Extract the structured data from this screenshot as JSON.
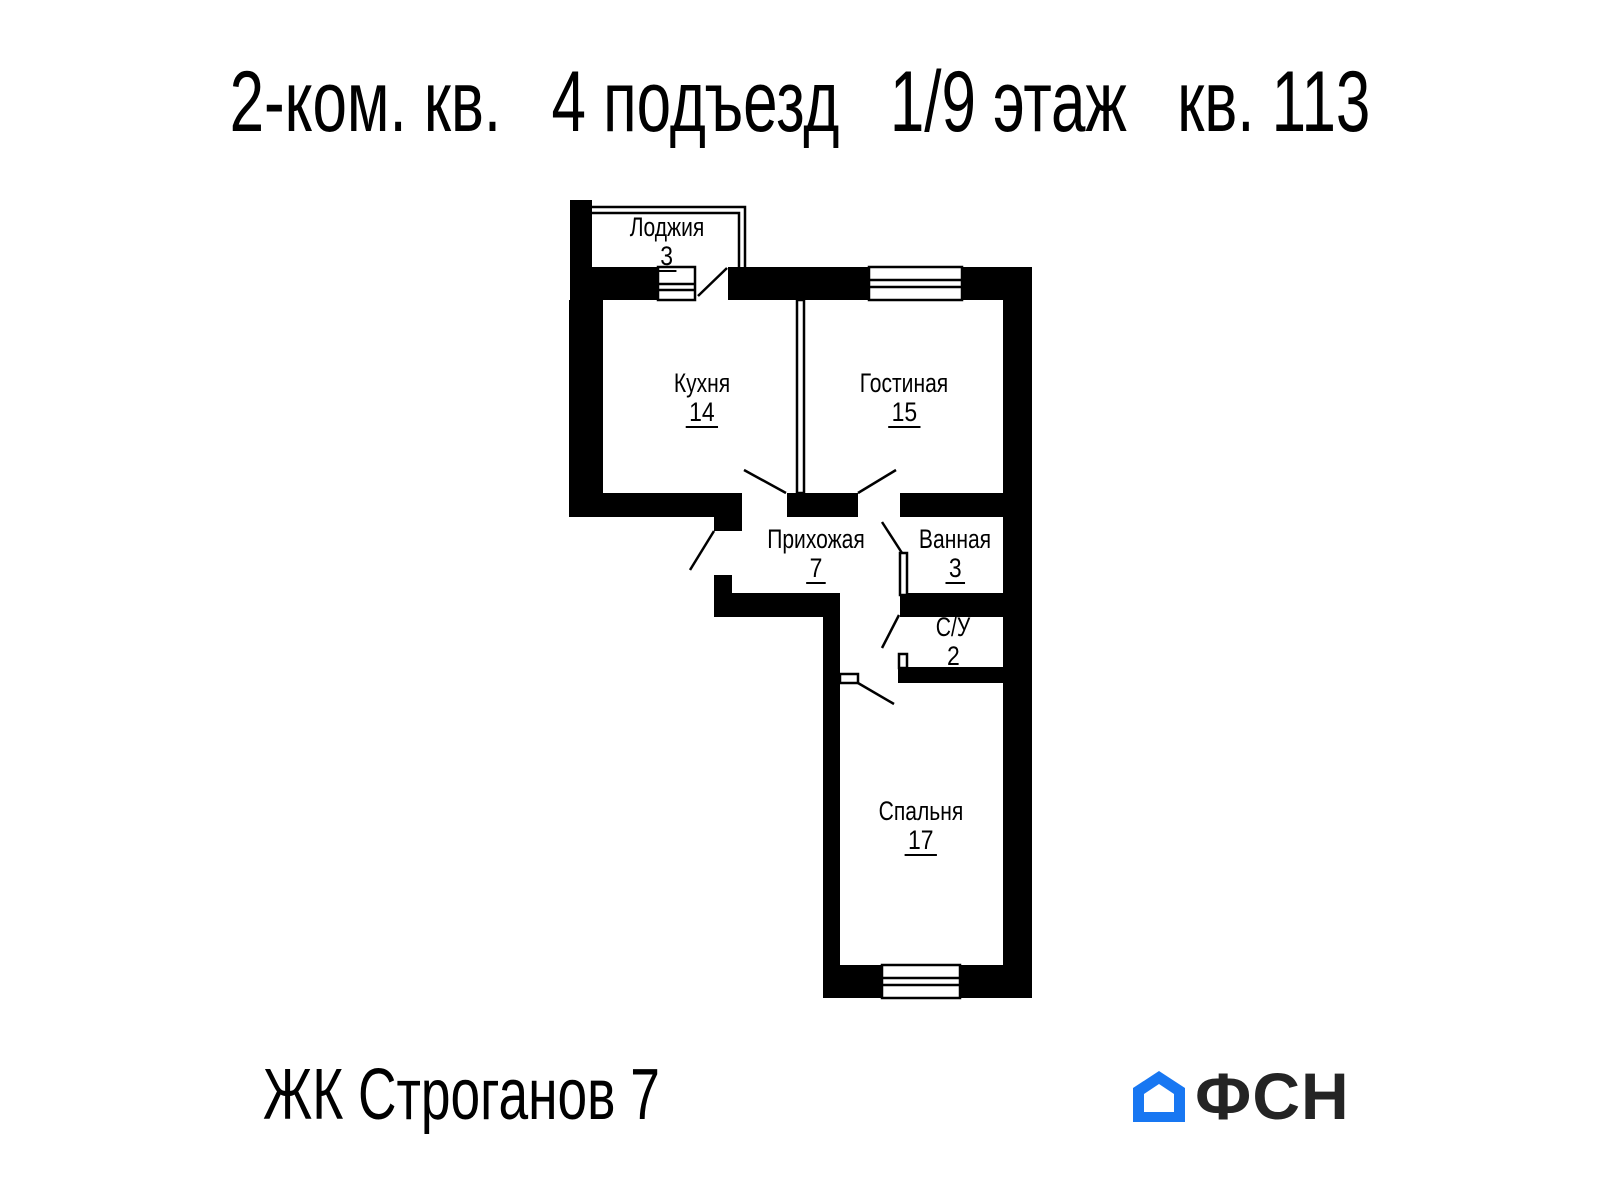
{
  "title": {
    "parts": [
      "2-ком. кв.",
      "4 подъезд",
      "1/9 этаж",
      "кв. 113"
    ]
  },
  "rooms": [
    {
      "id": "loggia",
      "name": "Лоджия",
      "area": "3"
    },
    {
      "id": "kitchen",
      "name": "Кухня",
      "area": "14"
    },
    {
      "id": "living",
      "name": "Гостиная",
      "area": "15"
    },
    {
      "id": "hallway",
      "name": "Прихожая",
      "area": "7"
    },
    {
      "id": "bathroom",
      "name": "Ванная",
      "area": "3"
    },
    {
      "id": "wc",
      "name": "С/У",
      "area": "2"
    },
    {
      "id": "bedroom",
      "name": "Спальня",
      "area": "17"
    }
  ],
  "footer": {
    "complex_name": "ЖК Строганов 7",
    "logo_text": "ФСН"
  },
  "colors": {
    "wall": "#000000",
    "logo_blue": "#1877F2",
    "logo_text": "#242424"
  }
}
